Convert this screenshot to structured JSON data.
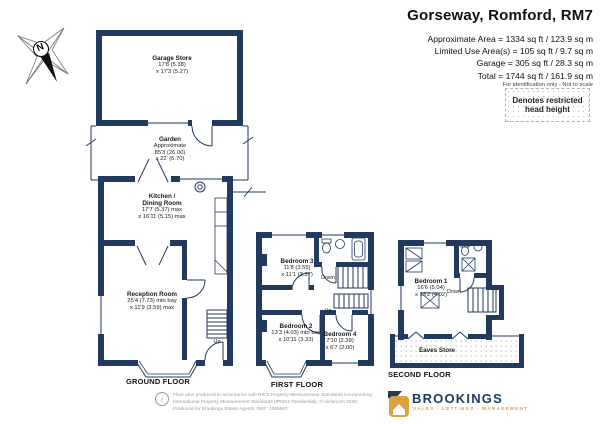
{
  "header": {
    "title": "Gorseway, Romford, RM7",
    "area_lines": [
      "Approximate Area = 1334 sq ft / 123.9 sq m",
      "Limited Use Area(s) = 105 sq ft / 9.7 sq m",
      "Garage = 305 sq ft / 28.3 sq m",
      "Total = 1744 sq ft / 161.9 sq m"
    ],
    "note": "For identification only - Not to scale",
    "legend": "Denotes restricted head height"
  },
  "compass": {
    "north": "N"
  },
  "floors": {
    "ground": "GROUND FLOOR",
    "first": "FIRST FLOOR",
    "second": "SECOND FLOOR"
  },
  "rooms": {
    "garage_store": {
      "name": "Garage Store",
      "dim1": "17'8 (5.38)",
      "dim2": "x 17'3 (5.27)"
    },
    "garden": {
      "name": "Garden",
      "note": "Approximate",
      "dim1": "85'3 (26.00)",
      "dim2": "x 22' (6.70)"
    },
    "kitchen": {
      "name1": "Kitchen /",
      "name2": "Dining Room",
      "dim1": "17'7 (5.37) max",
      "dim2": "x 16'11 (5.15) max"
    },
    "reception": {
      "name": "Reception Room",
      "dim1": "25'4 (7.73) into bay",
      "dim2": "x 11'9 (3.59) max"
    },
    "bedroom3": {
      "name": "Bedroom 3",
      "dim1": "11'8 (3.55)",
      "dim2": "x 11'1 (3.37)"
    },
    "bedroom2": {
      "name": "Bedroom 2",
      "dim1": "13'3 (4.03) into bay",
      "dim2": "x 10'11 (3.33)"
    },
    "bedroom4": {
      "name": "Bedroom 4",
      "dim1": "7'10 (2.39)",
      "dim2": "x 6'7 (2.00)"
    },
    "bedroom1": {
      "name": "Bedroom 1",
      "dim1": "16'6 (5.04)",
      "dim2": "x 13'2 (4.02)"
    },
    "eaves_store": {
      "name": "Eaves Store"
    }
  },
  "stairs": {
    "up": "Up",
    "down": "Down"
  },
  "footer": {
    "disclaimer1": "Floor plan produced in accordance with RICS Property Measurement Standards incorporating",
    "disclaimer2": "International Property Measurement Standards (IPMS2 Residential).  © nichecom 2026.",
    "disclaimer3": "Produced for Brookings Estate Agents.   REF: 1399687",
    "brand": {
      "name": "BROOKINGS",
      "tagline": "SALES · LETTINGS · MANAGEMENT"
    }
  },
  "colors": {
    "wall": "#223a5e",
    "brand_navy": "#1d3c5e",
    "brand_gold": "#dfa13d"
  }
}
